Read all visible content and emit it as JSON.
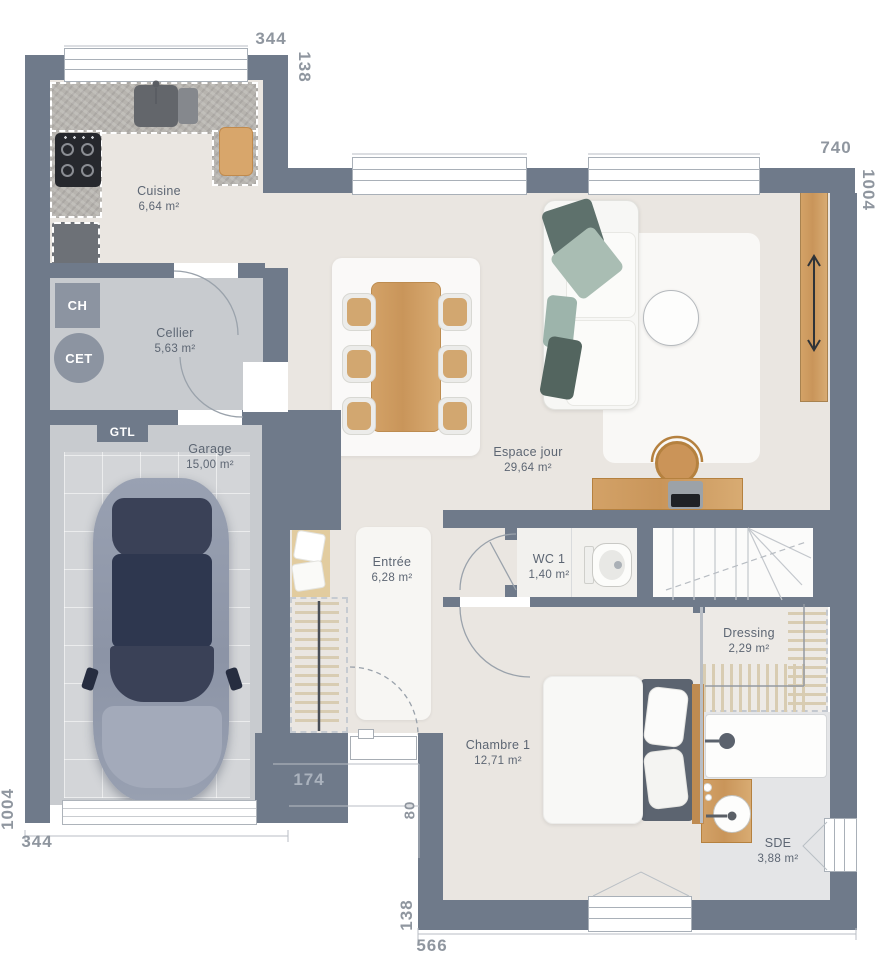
{
  "plan": {
    "title": "Plan de maison - rez-de-chaussée",
    "rooms": {
      "cuisine": {
        "name": "Cuisine",
        "area": "6,64 m²"
      },
      "cellier": {
        "name": "Cellier",
        "area": "5,63 m²"
      },
      "garage": {
        "name": "Garage",
        "area": "15,00 m²"
      },
      "espace_jour": {
        "name": "Espace jour",
        "area": "29,64 m²"
      },
      "entree": {
        "name": "Entrée",
        "area": "6,28 m²"
      },
      "wc1": {
        "name": "WC 1",
        "area": "1,40 m²"
      },
      "chambre1": {
        "name": "Chambre 1",
        "area": "12,71 m²"
      },
      "dressing": {
        "name": "Dressing",
        "area": "2,29 m²"
      },
      "sde": {
        "name": "SDE",
        "area": "3,88 m²"
      }
    },
    "equipment": {
      "ch": "CH",
      "cet": "CET",
      "gtl": "GTL"
    },
    "dimensions": {
      "top_left_width": "344",
      "top_step_depth": "138",
      "top_main_width": "740",
      "right_height": "1004",
      "left_height": "1004",
      "bottom_left_width": "344",
      "porch_width": "174",
      "porch_depth": "80",
      "bottom_step_depth": "138",
      "bottom_main_width": "566"
    },
    "colors": {
      "wall": "#6F7A8A",
      "floor_warm": "#EAE6E1",
      "floor_garage": "#C8CBCF",
      "wood": "#CE9D62",
      "sage": "#A9BDB3",
      "car_navy": "#2F3850"
    }
  }
}
